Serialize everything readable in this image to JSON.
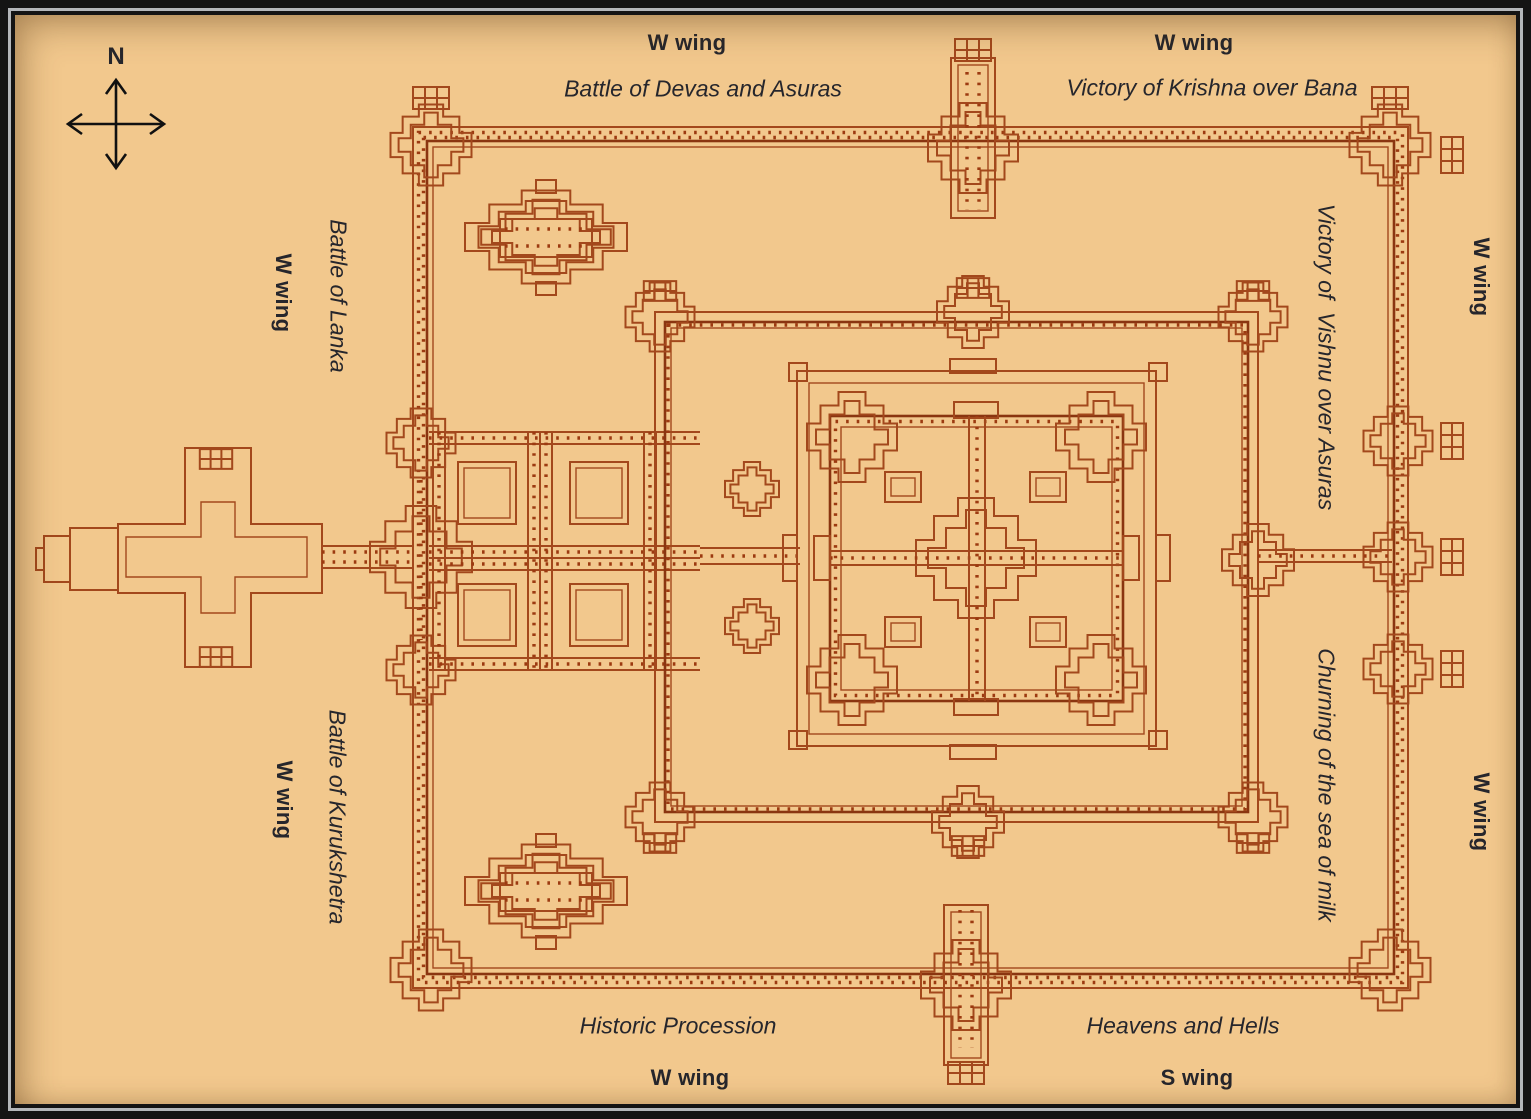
{
  "compass": {
    "north_label": "N"
  },
  "galleries": {
    "north_west": {
      "wing": "W wing",
      "relief": "Battle of Devas and Asuras"
    },
    "north_east": {
      "wing": "W wing",
      "relief": "Victory of Krishna over Bana"
    },
    "west_upper": {
      "wing": "W wing",
      "relief": "Battle of Lanka"
    },
    "east_upper": {
      "wing": "W wing",
      "relief": "Victory of  Vishnu over Asuras"
    },
    "west_lower": {
      "wing": "W wing",
      "relief": "Battle of Kurukshetra"
    },
    "east_lower": {
      "wing": "W wing",
      "relief": "Churning of the sea of milk"
    },
    "south_west": {
      "wing": "W wing",
      "relief": "Historic Procession"
    },
    "south_east": {
      "wing": "S wing",
      "relief": "Heavens and Hells"
    }
  },
  "colors": {
    "background": "#f2c88d",
    "plan_line": "#a3481c",
    "plan_line_dark": "#8a3510",
    "column_dot": "#9c3a10",
    "text": "#26262c",
    "frame": "#141414",
    "frame_accent": "#b4b7ba"
  }
}
